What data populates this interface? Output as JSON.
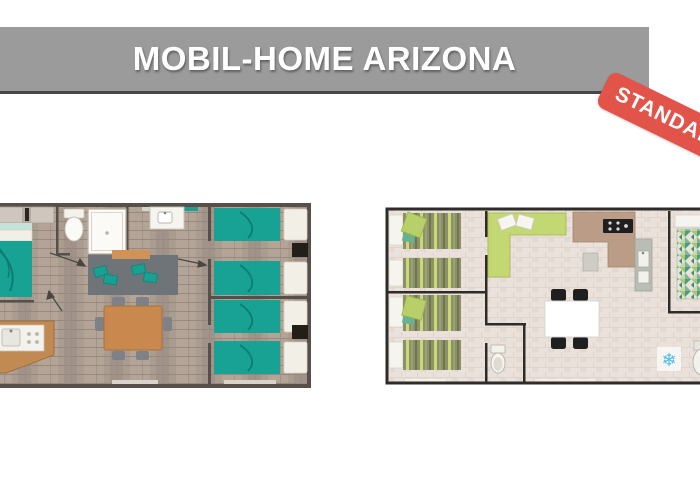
{
  "header": {
    "title": "MOBIL-HOME ARIZONA",
    "badge_label": "STANDARD",
    "bar_color": "#9b9b9b",
    "bar_underline_color": "#474747",
    "title_color": "#ffffff",
    "badge_color": "#e2534a"
  },
  "plans": {
    "left": {
      "label": "floor-plan-wood-teal",
      "colors": {
        "floor": "#ab9c90",
        "wall": "#57504a",
        "bed": "#17a294",
        "bed_headboard": "#c2e2da",
        "linen_white": "#f2efe7",
        "sofa": "#6f7478",
        "table_wood": "#c8884e",
        "chair": "#7e8287",
        "kitchen_counter": "#c08a52",
        "wardrobe": "#241e19"
      },
      "rooms": [
        "master-bedroom",
        "bathroom",
        "living-room",
        "kitchen",
        "twin-bedroom-1",
        "twin-bedroom-2"
      ]
    },
    "right": {
      "label": "floor-plan-tile-green",
      "ac_icon": "❄",
      "colors": {
        "floor": "#eae1db",
        "wall": "#2e2b28",
        "bed_olive": "#8d9168",
        "bed_lime": "#ccd96f",
        "sofa_lime": "#c3d773",
        "kitchen_counter": "#bb9c86",
        "worktop_gray": "#b9bdb5",
        "stove": "#1f1f1f",
        "table": "#ffffff",
        "chair": "#1f1f1f",
        "mosaic_teal": "#4a9c86",
        "ac_blue": "#49bce8"
      },
      "rooms": [
        "twin-bedroom-1",
        "twin-bedroom-2",
        "living-room",
        "kitchen",
        "wc",
        "master-bedroom",
        "bathroom"
      ]
    }
  }
}
